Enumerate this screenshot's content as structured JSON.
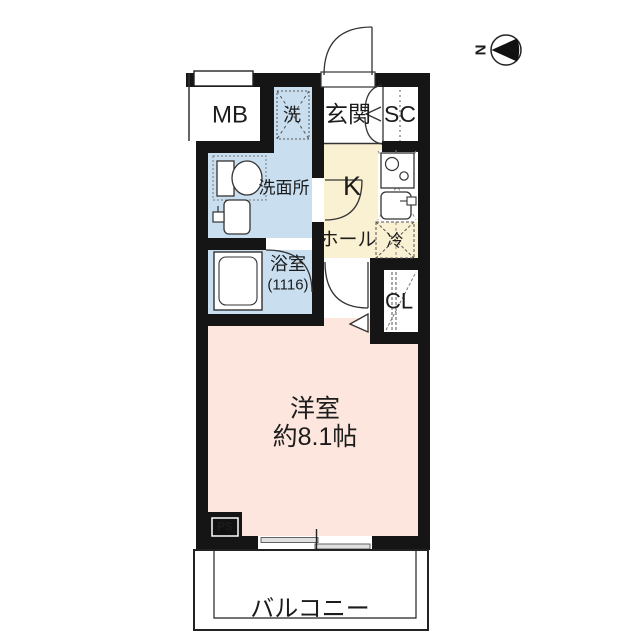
{
  "floorplan": {
    "compass": {
      "north_label": "N"
    },
    "rooms": {
      "meter_box": "MB",
      "laundry": "洗",
      "entrance": "玄関",
      "shoe_closet": "SC",
      "washroom": "洗面所",
      "kitchen": "K",
      "hall": "ホール",
      "fridge": "冷",
      "bathroom": "浴室",
      "bathroom_size": "(1116)",
      "closet": "CL",
      "western_room": "洋室",
      "western_room_size": "約8.1帖",
      "pipe_space": "PS",
      "balcony": "バルコニー"
    },
    "colors": {
      "water_blue": "#c9dff0",
      "kitchen_cream": "#faf0d2",
      "room_pink": "#fce6de",
      "wall": "#151515"
    }
  }
}
